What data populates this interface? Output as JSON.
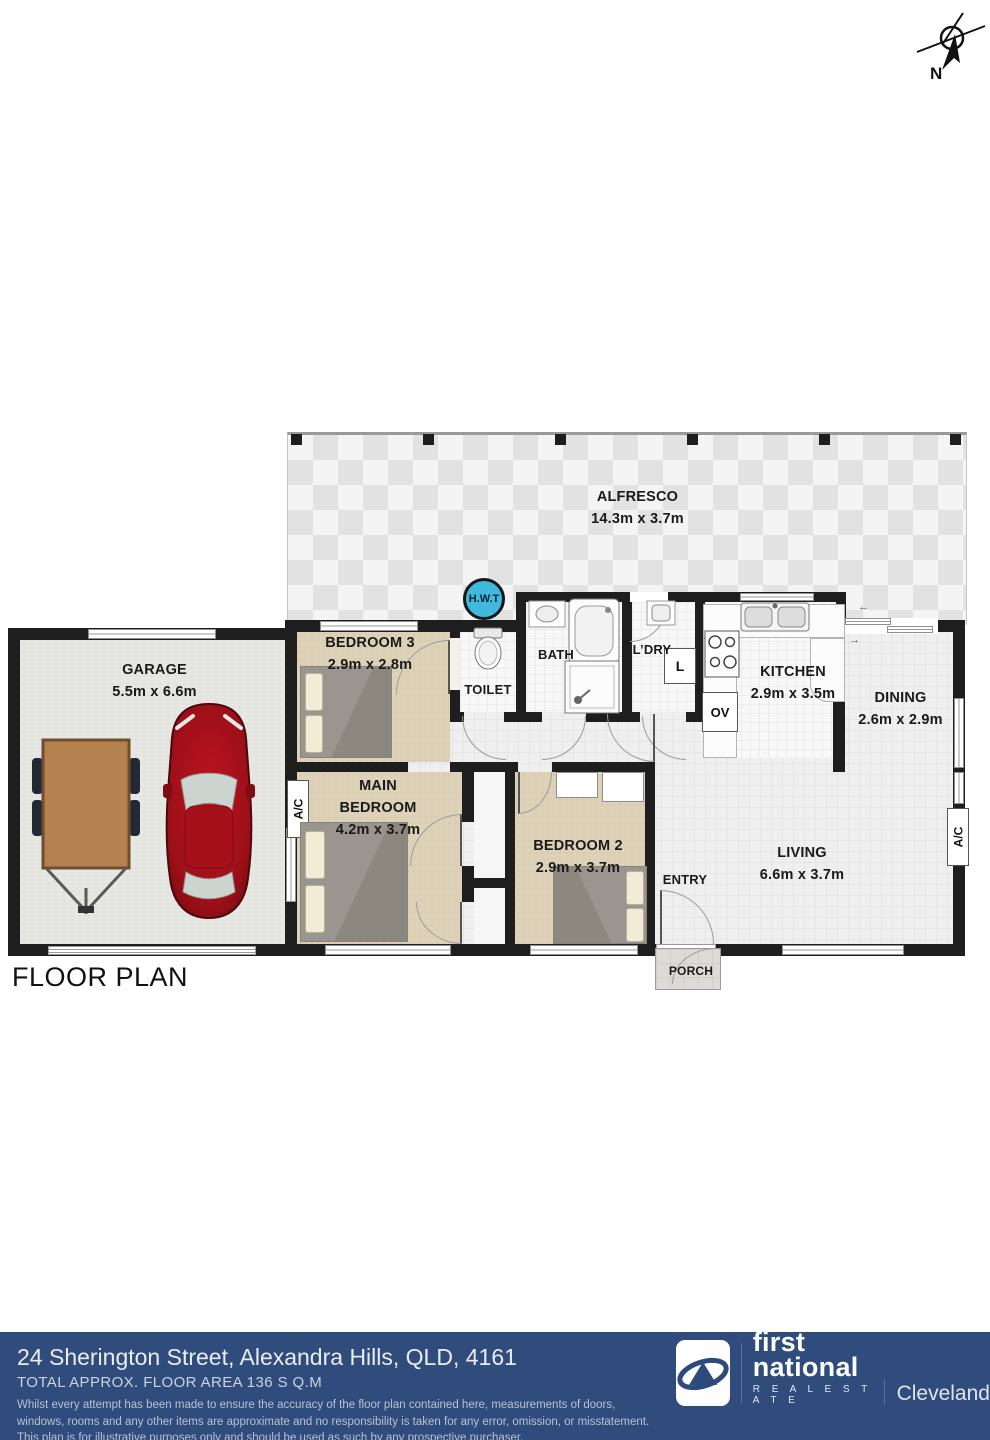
{
  "compass": {
    "label": "N"
  },
  "plan": {
    "title": "FLOOR PLAN",
    "rooms": {
      "alfresco": {
        "name": "ALFRESCO",
        "dims": "14.3m x 3.7m"
      },
      "garage": {
        "name": "GARAGE",
        "dims": "5.5m x 6.6m"
      },
      "bedroom3": {
        "name": "BEDROOM 3",
        "dims": "2.9m x 2.8m"
      },
      "toilet": {
        "name": "TOILET"
      },
      "bath": {
        "name": "BATH"
      },
      "laundry": {
        "name": "L’DRY"
      },
      "kitchen": {
        "name": "KITCHEN",
        "dims": "2.9m x 3.5m"
      },
      "dining": {
        "name": "DINING",
        "dims": "2.6m x 2.9m"
      },
      "main_bedroom": {
        "name": "MAIN BEDROOM",
        "dims": "4.2m x 3.7m"
      },
      "bedroom2": {
        "name": "BEDROOM 2",
        "dims": "2.9m x 3.7m"
      },
      "living": {
        "name": "LIVING",
        "dims": "6.6m x 3.7m"
      },
      "entry": {
        "name": "ENTRY"
      },
      "porch": {
        "name": "PORCH"
      }
    },
    "fixtures": {
      "hot_water": "H.W.T",
      "ac": "A/C",
      "oven": "OV",
      "laundry_tub": "L"
    },
    "slider": {
      "left": "←",
      "right": "→"
    }
  },
  "footer": {
    "address": "24 Sherington Street, Alexandra Hills, QLD, 4161",
    "floor_area": "TOTAL APPROX. FLOOR AREA 136 S Q.M",
    "disclaimer_lines": [
      "Whilst every attempt has been made to ensure the accuracy of the floor plan contained here, measurements of doors,",
      "windows, rooms and any other items are approximate and no responsibility is taken for any error, omission, or misstatement.",
      "This plan is for illustrative purposes only and should be used as such by any prospective purchaser."
    ],
    "brand": {
      "word1": "first",
      "word2": "national",
      "tagline": "R E A L   E S T A T E",
      "office": "Cleveland"
    }
  },
  "colors": {
    "footer_bg": "#304c7c",
    "hwt_cyan": "#41b9dd",
    "car_red": "#a01018",
    "trailer_brown": "#b5814f",
    "carpet_beige": "#ddd2b8",
    "wall_black": "#1e1e1e"
  }
}
